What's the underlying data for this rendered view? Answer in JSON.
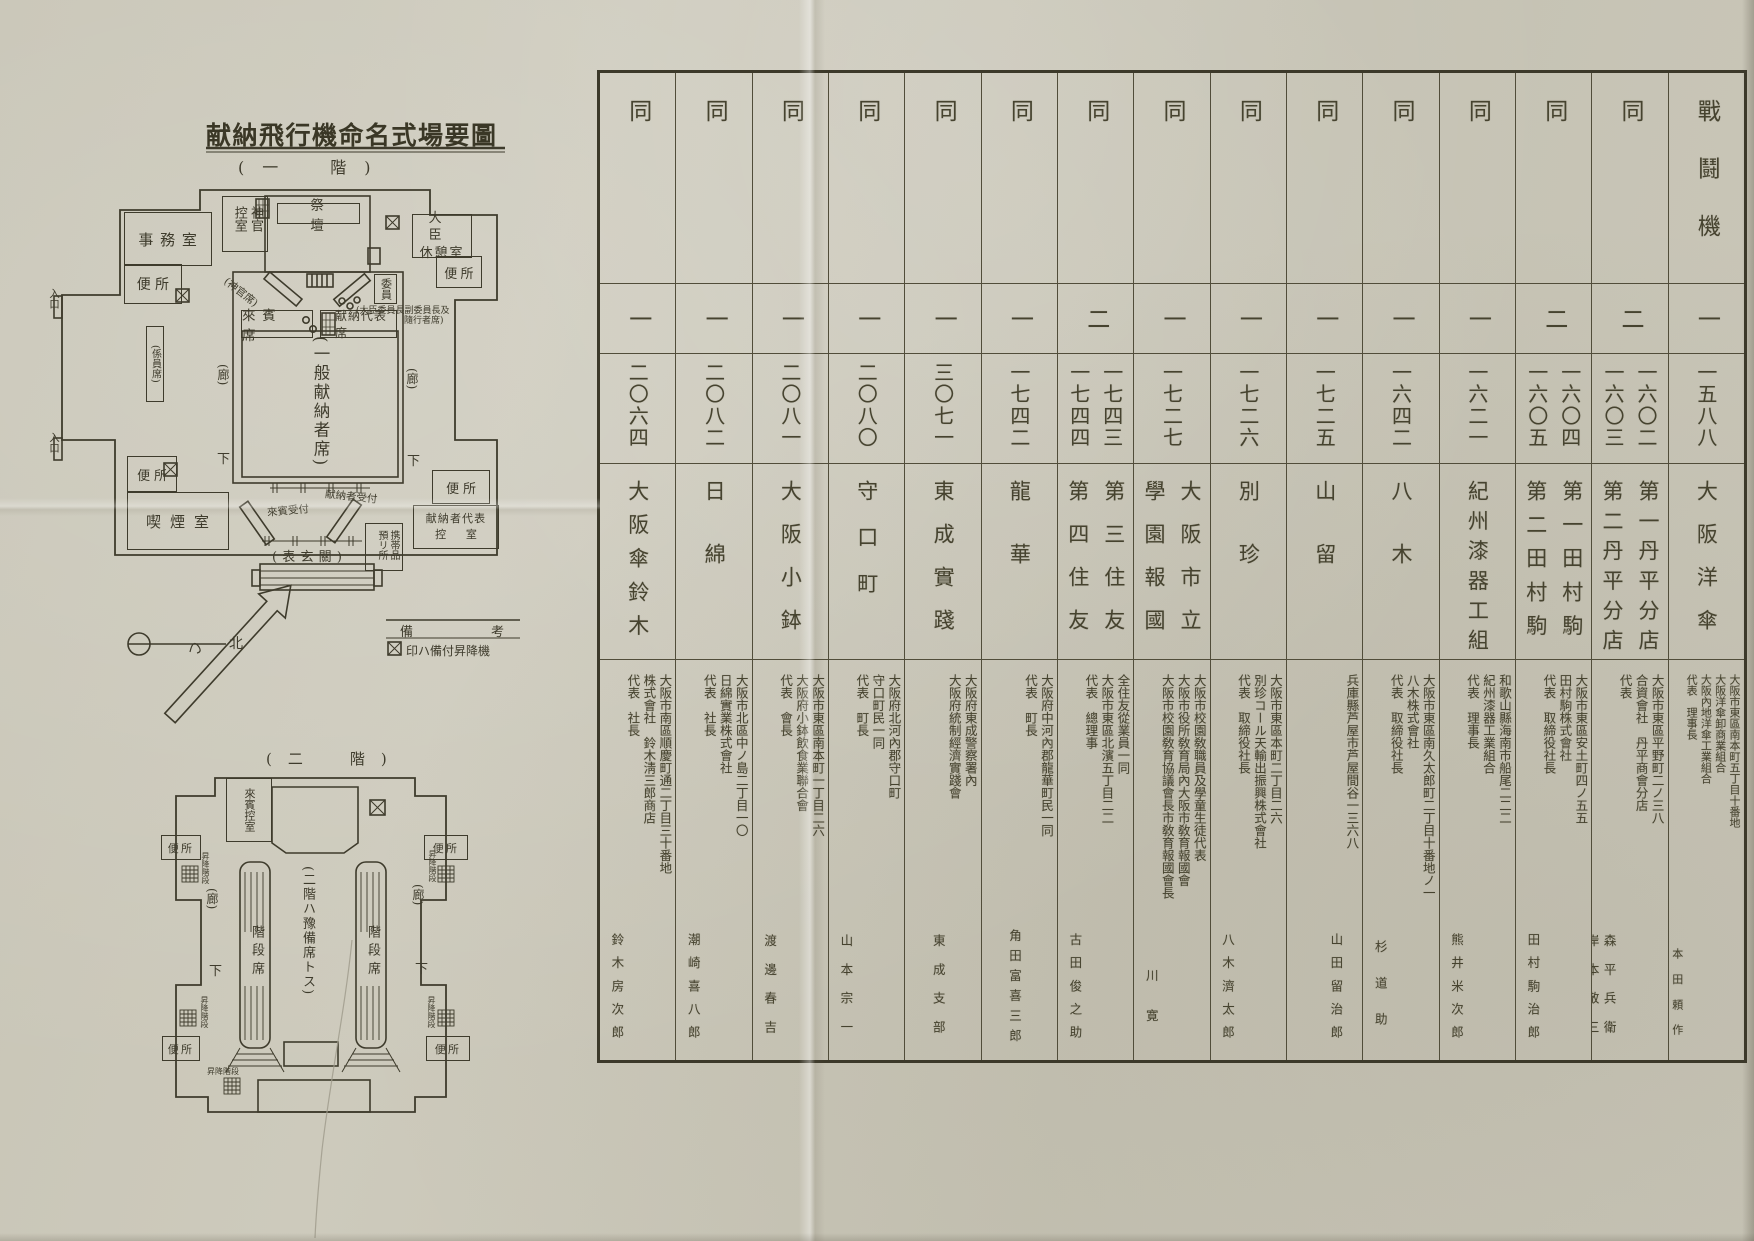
{
  "document": {
    "diagram_title": "献納飛行機命名式場要圖",
    "floor1_label": "(一　階)",
    "floor2_label": "(二　階)"
  },
  "legend": {
    "title": "備考",
    "note": "印ハ備付昇降機",
    "north": "北"
  },
  "plan_labels": {
    "office": "事務室",
    "toilet": "便所",
    "priest_waiting": "神官控室",
    "altar": "祭壇",
    "minister_rest_line1": "大臣",
    "minister_rest_line2": "休憩室",
    "entrance": "入口",
    "priest_seats": "(神官席)",
    "committee": "委員",
    "committee_note1": "(大臣委員長副委員長及",
    "committee_note2": "隨行者席)",
    "guest_seats": "來賓席",
    "donor_rep_seats": "献納代表席",
    "staff_seats": "(係員席)",
    "general_donor_seats": "(一般献納者席)",
    "corridor": "(廊)",
    "down": "下",
    "smoking_room": "喫煙室",
    "guest_reception": "來賓受付",
    "donor_reception": "献納者受付",
    "cloakroom": "携帯品預リ所",
    "donor_rep_room_line1": "献納者代表",
    "donor_rep_room_line2": "控室",
    "front_entrance": "(表玄關)",
    "guest_waiting": "來賓控室",
    "stair_seats": "階段席",
    "floor2_note": "(二階ハ豫備席トス)",
    "lift_stairs": "昇降階段"
  },
  "table": {
    "columns": [
      {
        "type": "戰鬪機",
        "count": "一",
        "serials": [
          "一五八八"
        ],
        "names": [
          "大阪洋傘"
        ],
        "details": [
          "大阪市東區南本町五丁目十番地",
          "大阪洋傘卸商業組合",
          "大阪內地洋傘工業組合",
          "代表　理事長"
        ],
        "representatives": [
          "本田頼作"
        ]
      },
      {
        "type": "同",
        "count": "二",
        "serials": [
          "一六〇二",
          "一六〇三"
        ],
        "names": [
          "第一丹平分店",
          "第二丹平分店"
        ],
        "details": [
          "大阪市東區平野町二ノ三八",
          "合資會社　丹平商會分店",
          "代表"
        ],
        "representatives": [
          "森平兵衛",
          "岸本敬三"
        ]
      },
      {
        "type": "同",
        "count": "二",
        "serials": [
          "一六〇四",
          "一六〇五"
        ],
        "names": [
          "第一田村駒",
          "第二田村駒"
        ],
        "details": [
          "大阪市東區安土町四ノ五五",
          "田村駒株式會社",
          "代表　取締役社長"
        ],
        "representatives": [
          "田村駒治郎"
        ]
      },
      {
        "type": "同",
        "count": "一",
        "serials": [
          "一六二一"
        ],
        "names": [
          "紀州漆器工組"
        ],
        "details": [
          "和歌山縣海南市船尾二二二",
          "紀州漆器工業組合",
          "代表　理事長"
        ],
        "representatives": [
          "熊井米次郎"
        ]
      },
      {
        "type": "同",
        "count": "一",
        "serials": [
          "一六四二"
        ],
        "names": [
          "八木"
        ],
        "details": [
          "大阪市東區南久太郎町二丁目十番地ノ一",
          "八木株式會社",
          "代表　取締役社長"
        ],
        "representatives": [
          "杉道助"
        ]
      },
      {
        "type": "同",
        "count": "一",
        "serials": [
          "一七二五"
        ],
        "names": [
          "山留"
        ],
        "details": [
          "兵庫縣芦屋市芦屋間谷一三六八"
        ],
        "representatives": [
          "山田留治郎"
        ]
      },
      {
        "type": "同",
        "count": "一",
        "serials": [
          "一七二六"
        ],
        "names": [
          "別珍"
        ],
        "details": [
          "大阪市東區本町二丁目二六",
          "別珍コール天輸出振興株式會社",
          "代表　取締役社長"
        ],
        "representatives": [
          "八木濟太郎"
        ]
      },
      {
        "type": "同",
        "count": "一",
        "serials": [
          "一七二七"
        ],
        "names": [
          "大阪市立",
          "學園報國"
        ],
        "details": [
          "大阪市校園敎職員及學童生徒代表",
          "大阪市役所敎育局內大阪市敎育報國會",
          "大阪市校園敎育協議會長市敎育報國會長"
        ],
        "representatives": [
          "川寛"
        ]
      },
      {
        "type": "同",
        "count": "二",
        "serials": [
          "一七四三",
          "一七四四"
        ],
        "names": [
          "第三住友",
          "第四住友"
        ],
        "details": [
          "全住友從業員一同",
          "大阪市東區北濱五丁目二二",
          "代表　總理事"
        ],
        "representatives": [
          "古田俊之助"
        ]
      },
      {
        "type": "同",
        "count": "一",
        "serials": [
          "一七四二"
        ],
        "names": [
          "龍華"
        ],
        "details": [
          "大阪府中河內郡龍華町民一同",
          "代表　町長"
        ],
        "representatives": [
          "角田富喜三郎"
        ]
      },
      {
        "type": "同",
        "count": "一",
        "serials": [
          "三〇七一"
        ],
        "names": [
          "東成實踐"
        ],
        "details": [
          "大阪府東成警察署內",
          "大阪府統制經濟實踐會"
        ],
        "representatives": [
          "東成支部"
        ]
      },
      {
        "type": "同",
        "count": "一",
        "serials": [
          "二〇八〇"
        ],
        "names": [
          "守口町"
        ],
        "details": [
          "大阪府北河內郡守口町",
          "守口町民一同",
          "代表　町長"
        ],
        "representatives": [
          "山本宗一"
        ]
      },
      {
        "type": "同",
        "count": "一",
        "serials": [
          "二〇八一"
        ],
        "names": [
          "大阪小鉢"
        ],
        "details": [
          "大阪市東區南本町一丁目二六",
          "大阪府小鉢飲食業聯合會",
          "代表　會長"
        ],
        "representatives": [
          "渡邊春吉"
        ]
      },
      {
        "type": "同",
        "count": "一",
        "serials": [
          "二〇八二"
        ],
        "names": [
          "日綿"
        ],
        "details": [
          "大阪市北區中ノ島二丁目一〇",
          "日綿實業株式會社",
          "代表　社長"
        ],
        "representatives": [
          "潮崎喜八郎"
        ]
      },
      {
        "type": "同",
        "count": "一",
        "serials": [
          "二〇六四"
        ],
        "names": [
          "大阪傘鈴木"
        ],
        "details": [
          "大阪市南區順慶町通二丁目三十番地",
          "株式會社　鈴木淸三郎商店",
          "代表　社長"
        ],
        "representatives": [
          "鈴木房次郎"
        ]
      }
    ]
  }
}
